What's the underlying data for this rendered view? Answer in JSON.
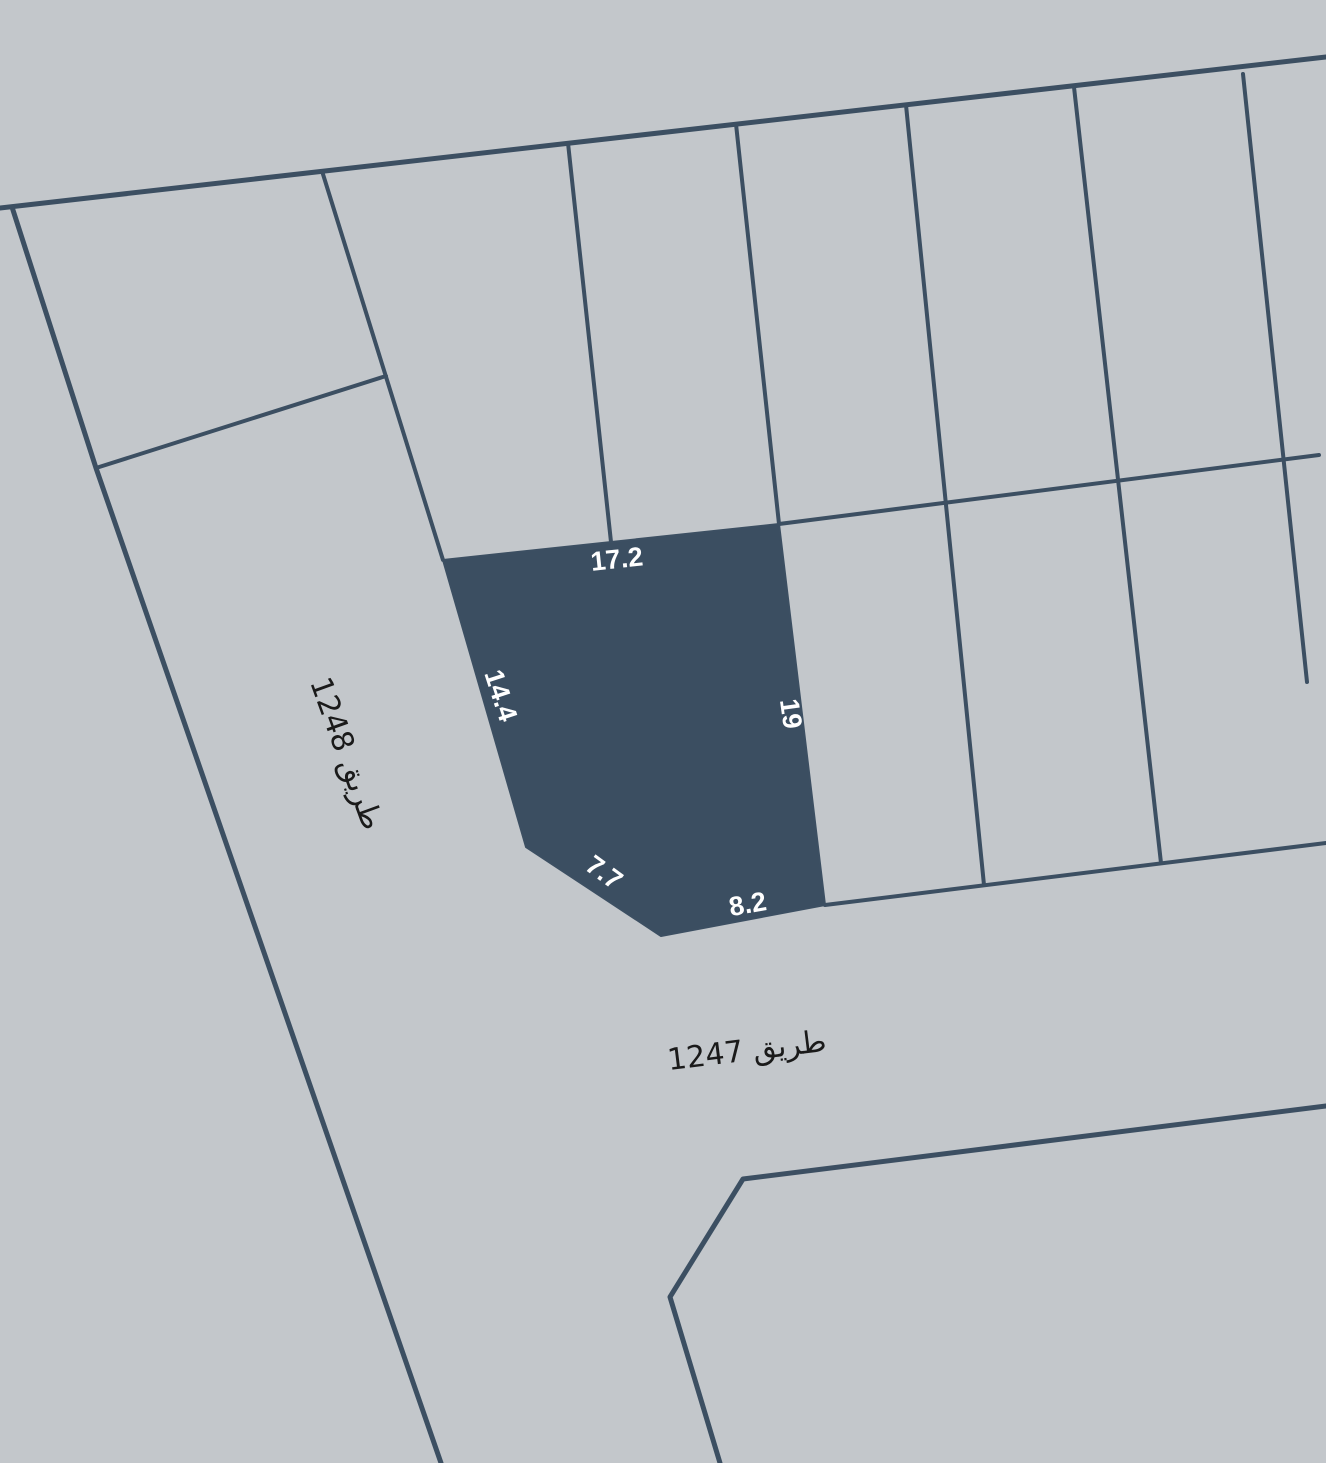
{
  "map": {
    "type": "cadastral-parcel-map",
    "background_color": "#c3c7cb",
    "boundary_color": "#3c4f62",
    "parcel": {
      "fill_color": "#3b4e61",
      "label_color": "#ffffff",
      "dimensions": {
        "top": "17.2",
        "left": "14.4",
        "right": "19",
        "bottom_left": "7.7",
        "bottom": "8.2"
      }
    },
    "roads": {
      "label_color": "#1a1a1a",
      "west": {
        "name": "طريق 1248"
      },
      "south": {
        "name": "طريق 1247"
      }
    }
  }
}
